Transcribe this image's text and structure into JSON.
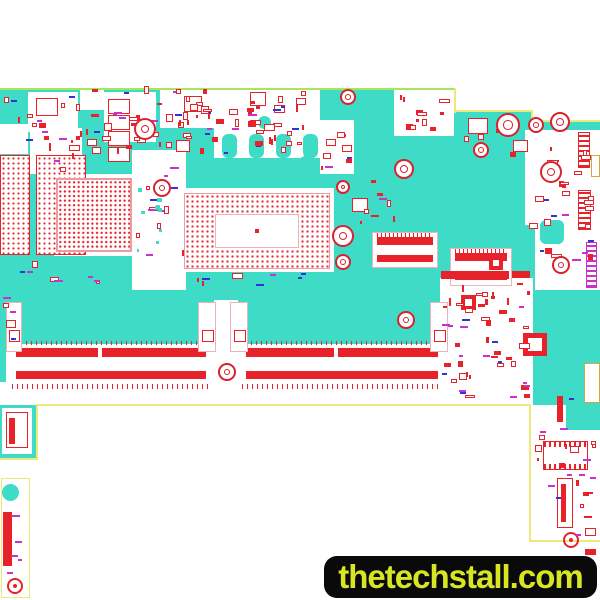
{
  "banner": {
    "text": "thetechstall.com"
  },
  "silkscreen": {
    "model": "GL4A0/GL5A0 NM-C631",
    "rev": "Rev:1.0",
    "origin": "Made in China",
    "brand": "Lenovo",
    "label": "VB02B:",
    "cert1": "2",
    "cert2": "L"
  },
  "colors": {
    "board": "#3edbc6",
    "red": "#e8222b",
    "outline": "#eee77b",
    "topedge": "#a6e55c",
    "magenta": "#cb2fcf",
    "blue": "#3333d4",
    "silk": "#3fcfbf",
    "hole": "#d8232e",
    "gold": "#d9a43b",
    "pink": "#efb2b6",
    "bga": "#ef9aa2",
    "banner_bg": "#0a0a0a",
    "banner_fg": "#d7e525"
  },
  "board": {
    "shapes": [
      {
        "t": "piece",
        "x": 0,
        "y": 90,
        "w": 456,
        "h": 315
      },
      {
        "t": "piece",
        "x": 455,
        "y": 112,
        "w": 78,
        "h": 293
      },
      {
        "t": "piece",
        "x": 531,
        "y": 122,
        "w": 69,
        "h": 420
      },
      {
        "t": "piece",
        "x": 0,
        "y": 405,
        "w": 38,
        "h": 54
      },
      {
        "t": "pieceE",
        "x": 1,
        "y": 478,
        "w": 29,
        "h": 120
      },
      {
        "t": "white",
        "x": 28,
        "y": 92,
        "w": 50,
        "h": 40
      },
      {
        "t": "white",
        "x": 80,
        "y": 88,
        "w": 24,
        "h": 22
      },
      {
        "t": "white",
        "x": 104,
        "y": 92,
        "w": 52,
        "h": 50
      },
      {
        "t": "white",
        "x": 160,
        "y": 90,
        "w": 54,
        "h": 38
      },
      {
        "t": "white",
        "x": 214,
        "y": 84,
        "w": 106,
        "h": 76
      },
      {
        "t": "white",
        "x": 312,
        "y": 120,
        "w": 42,
        "h": 54
      },
      {
        "t": "white",
        "x": 394,
        "y": 90,
        "w": 60,
        "h": 46
      },
      {
        "t": "white",
        "x": 30,
        "y": 128,
        "w": 52,
        "h": 46
      },
      {
        "t": "white",
        "x": 0,
        "y": 124,
        "w": 28,
        "h": 30
      },
      {
        "t": "white",
        "x": 54,
        "y": 174,
        "w": 84,
        "h": 82
      },
      {
        "t": "white",
        "x": 180,
        "y": 188,
        "w": 154,
        "h": 84
      },
      {
        "t": "white",
        "x": 132,
        "y": 150,
        "w": 54,
        "h": 140
      },
      {
        "t": "white",
        "x": 525,
        "y": 130,
        "w": 75,
        "h": 95
      },
      {
        "t": "white",
        "x": 535,
        "y": 225,
        "w": 65,
        "h": 65
      },
      {
        "t": "white",
        "x": 440,
        "y": 278,
        "w": 93,
        "h": 127
      },
      {
        "t": "white",
        "x": 0,
        "y": 382,
        "w": 533,
        "h": 23
      },
      {
        "t": "white",
        "x": 6,
        "y": 344,
        "w": 440,
        "h": 40
      },
      {
        "t": "white",
        "x": 214,
        "y": 300,
        "w": 24,
        "h": 46
      },
      {
        "t": "white",
        "x": 531,
        "y": 405,
        "w": 35,
        "h": 135
      },
      {
        "t": "white",
        "x": 566,
        "y": 430,
        "w": 34,
        "h": 112
      },
      {
        "t": "white",
        "x": 2,
        "y": 408,
        "w": 30,
        "h": 46
      },
      {
        "t": "pourx",
        "x": 214,
        "y": 158,
        "w": 106,
        "h": 16
      },
      {
        "t": "edge",
        "x": 0,
        "y": 88,
        "w": 456,
        "h": 2,
        "c": "#a6e55c"
      },
      {
        "t": "edge",
        "x": 454,
        "y": 88,
        "w": 2,
        "h": 25
      },
      {
        "t": "edge",
        "x": 454,
        "y": 110,
        "w": 79,
        "h": 2
      },
      {
        "t": "edge",
        "x": 531,
        "y": 110,
        "w": 2,
        "h": 13
      },
      {
        "t": "edge",
        "x": 531,
        "y": 120,
        "w": 69,
        "h": 2
      },
      {
        "t": "edge",
        "x": 38,
        "y": 404,
        "w": 493,
        "h": 2
      },
      {
        "t": "edge",
        "x": 36,
        "y": 404,
        "w": 2,
        "h": 56
      },
      {
        "t": "edge",
        "x": 0,
        "y": 458,
        "w": 38,
        "h": 2
      },
      {
        "t": "edge",
        "x": 529,
        "y": 404,
        "w": 2,
        "h": 138
      },
      {
        "t": "edge",
        "x": 529,
        "y": 540,
        "w": 71,
        "h": 2
      },
      {
        "t": "dotgrid",
        "x": 0,
        "y": 155,
        "w": 30,
        "h": 100
      },
      {
        "t": "dotgrid",
        "x": 36,
        "y": 155,
        "w": 50,
        "h": 100
      },
      {
        "t": "bgasq",
        "x": 56,
        "y": 178,
        "w": 76,
        "h": 74
      },
      {
        "t": "bgacpu",
        "x": 184,
        "y": 193,
        "w": 146,
        "h": 76
      },
      {
        "t": "bar",
        "x": 255,
        "y": 229,
        "w": 4,
        "h": 4
      },
      {
        "t": "conn",
        "x": 372,
        "y": 232,
        "w": 66,
        "h": 36
      },
      {
        "t": "conn",
        "x": 450,
        "y": 248,
        "w": 62,
        "h": 38
      },
      {
        "t": "bar",
        "x": 16,
        "y": 348,
        "w": 82,
        "h": 9
      },
      {
        "t": "bar",
        "x": 102,
        "y": 348,
        "w": 104,
        "h": 9
      },
      {
        "t": "bar",
        "x": 16,
        "y": 371,
        "w": 190,
        "h": 8
      },
      {
        "t": "bar",
        "x": 246,
        "y": 348,
        "w": 88,
        "h": 9
      },
      {
        "t": "bar",
        "x": 338,
        "y": 348,
        "w": 100,
        "h": 9
      },
      {
        "t": "bar",
        "x": 246,
        "y": 371,
        "w": 192,
        "h": 8
      },
      {
        "t": "ticks",
        "x": 12,
        "y": 384,
        "w": 196,
        "h": 5
      },
      {
        "t": "ticks",
        "x": 242,
        "y": 384,
        "w": 200,
        "h": 5
      },
      {
        "t": "ticks",
        "x": 16,
        "y": 341,
        "w": 190,
        "h": 4
      },
      {
        "t": "ticks",
        "x": 246,
        "y": 341,
        "w": 192,
        "h": 4
      },
      {
        "t": "latch",
        "x": 6,
        "y": 302,
        "w": 16,
        "h": 50
      },
      {
        "t": "latch",
        "x": 198,
        "y": 302,
        "w": 18,
        "h": 50
      },
      {
        "t": "latch",
        "x": 230,
        "y": 302,
        "w": 18,
        "h": 50
      },
      {
        "t": "latch",
        "x": 430,
        "y": 302,
        "w": 18,
        "h": 50
      },
      {
        "t": "sq",
        "x": 9,
        "y": 330,
        "w": 11,
        "h": 12
      },
      {
        "t": "sq",
        "x": 202,
        "y": 330,
        "w": 12,
        "h": 12
      },
      {
        "t": "sq",
        "x": 234,
        "y": 330,
        "w": 12,
        "h": 12
      },
      {
        "t": "sq",
        "x": 434,
        "y": 330,
        "w": 12,
        "h": 12
      },
      {
        "t": "ring",
        "x": 523,
        "y": 333,
        "w": 24,
        "h": 23,
        "b": 5
      },
      {
        "t": "ring",
        "x": 461,
        "y": 295,
        "w": 15,
        "h": 15
      },
      {
        "t": "ring",
        "x": 489,
        "y": 256,
        "w": 14,
        "h": 14
      },
      {
        "t": "chip",
        "x": 36,
        "y": 98,
        "w": 22,
        "h": 18
      },
      {
        "t": "chip",
        "x": 184,
        "y": 96,
        "w": 18,
        "h": 16
      },
      {
        "t": "chip",
        "x": 250,
        "y": 92,
        "w": 16,
        "h": 14
      },
      {
        "t": "chip",
        "x": 468,
        "y": 118,
        "w": 20,
        "h": 16
      },
      {
        "t": "chip",
        "x": 513,
        "y": 140,
        "w": 15,
        "h": 12
      },
      {
        "t": "chip",
        "x": 352,
        "y": 198,
        "w": 16,
        "h": 14
      },
      {
        "t": "chip",
        "x": 176,
        "y": 140,
        "w": 14,
        "h": 12
      },
      {
        "t": "chipcol",
        "x": 106,
        "y": 98,
        "w": 24,
        "h": 64,
        "n": 4
      },
      {
        "t": "chipdots",
        "x": 543,
        "y": 441,
        "w": 45,
        "h": 29
      },
      {
        "t": "chip",
        "x": 557,
        "y": 478,
        "w": 16,
        "h": 50
      },
      {
        "t": "bar",
        "x": 561,
        "y": 484,
        "w": 5,
        "h": 38
      },
      {
        "t": "chip",
        "x": 6,
        "y": 412,
        "w": 22,
        "h": 36
      },
      {
        "t": "bar",
        "x": 9,
        "y": 418,
        "w": 6,
        "h": 26
      },
      {
        "t": "bar",
        "x": 441,
        "y": 271,
        "w": 68,
        "h": 8
      },
      {
        "t": "bar",
        "x": 512,
        "y": 271,
        "w": 18,
        "h": 7
      },
      {
        "t": "bar",
        "x": 557,
        "y": 396,
        "w": 6,
        "h": 26
      },
      {
        "t": "bar",
        "x": 3,
        "y": 512,
        "w": 9,
        "h": 54
      },
      {
        "t": "bar",
        "x": 585,
        "y": 549,
        "w": 11,
        "h": 6
      },
      {
        "t": "rstripe",
        "x": 578,
        "y": 132,
        "w": 12,
        "h": 36
      },
      {
        "t": "rstripe",
        "x": 578,
        "y": 190,
        "w": 13,
        "h": 40
      },
      {
        "t": "mstripe",
        "x": 586,
        "y": 242,
        "w": 11,
        "h": 46
      },
      {
        "t": "gold",
        "x": 591,
        "y": 155,
        "w": 9,
        "h": 22
      },
      {
        "t": "gold",
        "x": 584,
        "y": 363,
        "w": 16,
        "h": 40
      },
      {
        "t": "tealc",
        "x": 2,
        "y": 484,
        "w": 17,
        "h": 17
      },
      {
        "t": "tealc",
        "x": 222,
        "y": 134,
        "w": 15,
        "h": 24,
        "rr": 6
      },
      {
        "t": "tealc",
        "x": 249,
        "y": 134,
        "w": 15,
        "h": 24,
        "rr": 6
      },
      {
        "t": "tealc",
        "x": 276,
        "y": 134,
        "w": 15,
        "h": 24,
        "rr": 6
      },
      {
        "t": "tealc",
        "x": 303,
        "y": 134,
        "w": 15,
        "h": 24,
        "rr": 6
      },
      {
        "t": "tealc",
        "x": 258,
        "y": 116,
        "w": 13,
        "h": 13
      },
      {
        "t": "tealc",
        "x": 299,
        "y": 156,
        "w": 13,
        "h": 13
      },
      {
        "t": "tealc",
        "x": 245,
        "y": 158,
        "w": 13,
        "h": 13
      },
      {
        "t": "tealc",
        "x": 540,
        "y": 220,
        "w": 24,
        "h": 24,
        "rr": 6
      },
      {
        "t": "target",
        "x": 563,
        "y": 532,
        "w": 16,
        "h": 16
      },
      {
        "t": "target",
        "x": 7,
        "y": 578,
        "w": 16,
        "h": 16
      }
    ],
    "clusters": [
      {
        "x": 86,
        "y": 96,
        "w": 200,
        "h": 58,
        "n": 48,
        "seed": 11
      },
      {
        "x": 228,
        "y": 88,
        "w": 78,
        "h": 62,
        "n": 22,
        "seed": 22
      },
      {
        "x": 2,
        "y": 94,
        "w": 80,
        "h": 52,
        "n": 14,
        "seed": 33
      },
      {
        "x": 314,
        "y": 124,
        "w": 38,
        "h": 46,
        "n": 10,
        "seed": 44
      },
      {
        "x": 398,
        "y": 94,
        "w": 52,
        "h": 38,
        "n": 12,
        "seed": 55
      },
      {
        "x": 528,
        "y": 135,
        "w": 66,
        "h": 140,
        "n": 30,
        "seed": 66
      },
      {
        "x": 134,
        "y": 154,
        "w": 50,
        "h": 120,
        "n": 13,
        "seed": 88
      },
      {
        "x": 188,
        "y": 270,
        "w": 118,
        "h": 16,
        "n": 8,
        "seed": 99
      },
      {
        "x": 442,
        "y": 282,
        "w": 88,
        "h": 116,
        "n": 52,
        "seed": 111
      },
      {
        "x": 534,
        "y": 392,
        "w": 62,
        "h": 144,
        "n": 16,
        "seed": 122
      },
      {
        "x": 0,
        "y": 292,
        "w": 16,
        "h": 48,
        "n": 5,
        "seed": 144
      },
      {
        "x": 136,
        "y": 184,
        "w": 26,
        "h": 70,
        "n": 10,
        "seed": 155,
        "p": "teal"
      },
      {
        "x": 82,
        "y": 88,
        "w": 130,
        "h": 6,
        "n": 6,
        "seed": 166
      },
      {
        "x": 4,
        "y": 498,
        "w": 24,
        "h": 76,
        "n": 5,
        "seed": 177,
        "p": "label"
      },
      {
        "x": 352,
        "y": 176,
        "w": 56,
        "h": 48,
        "n": 8,
        "seed": 188
      },
      {
        "x": 460,
        "y": 122,
        "w": 56,
        "h": 38,
        "n": 6,
        "seed": 199
      },
      {
        "x": 36,
        "y": 132,
        "w": 44,
        "h": 40,
        "n": 8,
        "seed": 211
      },
      {
        "x": 162,
        "y": 94,
        "w": 50,
        "h": 32,
        "n": 8,
        "seed": 222
      },
      {
        "x": 566,
        "y": 440,
        "w": 30,
        "h": 95,
        "n": 8,
        "seed": 233
      },
      {
        "x": 20,
        "y": 255,
        "w": 80,
        "h": 30,
        "n": 8,
        "seed": 244
      }
    ],
    "holes": [
      {
        "x": 145,
        "y": 129,
        "r": 11
      },
      {
        "x": 162,
        "y": 188,
        "r": 9
      },
      {
        "x": 348,
        "y": 97,
        "r": 8
      },
      {
        "x": 404,
        "y": 169,
        "r": 10
      },
      {
        "x": 343,
        "y": 187,
        "r": 7
      },
      {
        "x": 343,
        "y": 236,
        "r": 11
      },
      {
        "x": 343,
        "y": 262,
        "r": 8
      },
      {
        "x": 406,
        "y": 320,
        "r": 9
      },
      {
        "x": 508,
        "y": 125,
        "r": 12
      },
      {
        "x": 536,
        "y": 125,
        "r": 8
      },
      {
        "x": 560,
        "y": 122,
        "r": 10
      },
      {
        "x": 481,
        "y": 150,
        "r": 8
      },
      {
        "x": 551,
        "y": 172,
        "r": 11
      },
      {
        "x": 561,
        "y": 265,
        "r": 9
      },
      {
        "x": 227,
        "y": 372,
        "r": 9
      }
    ]
  }
}
